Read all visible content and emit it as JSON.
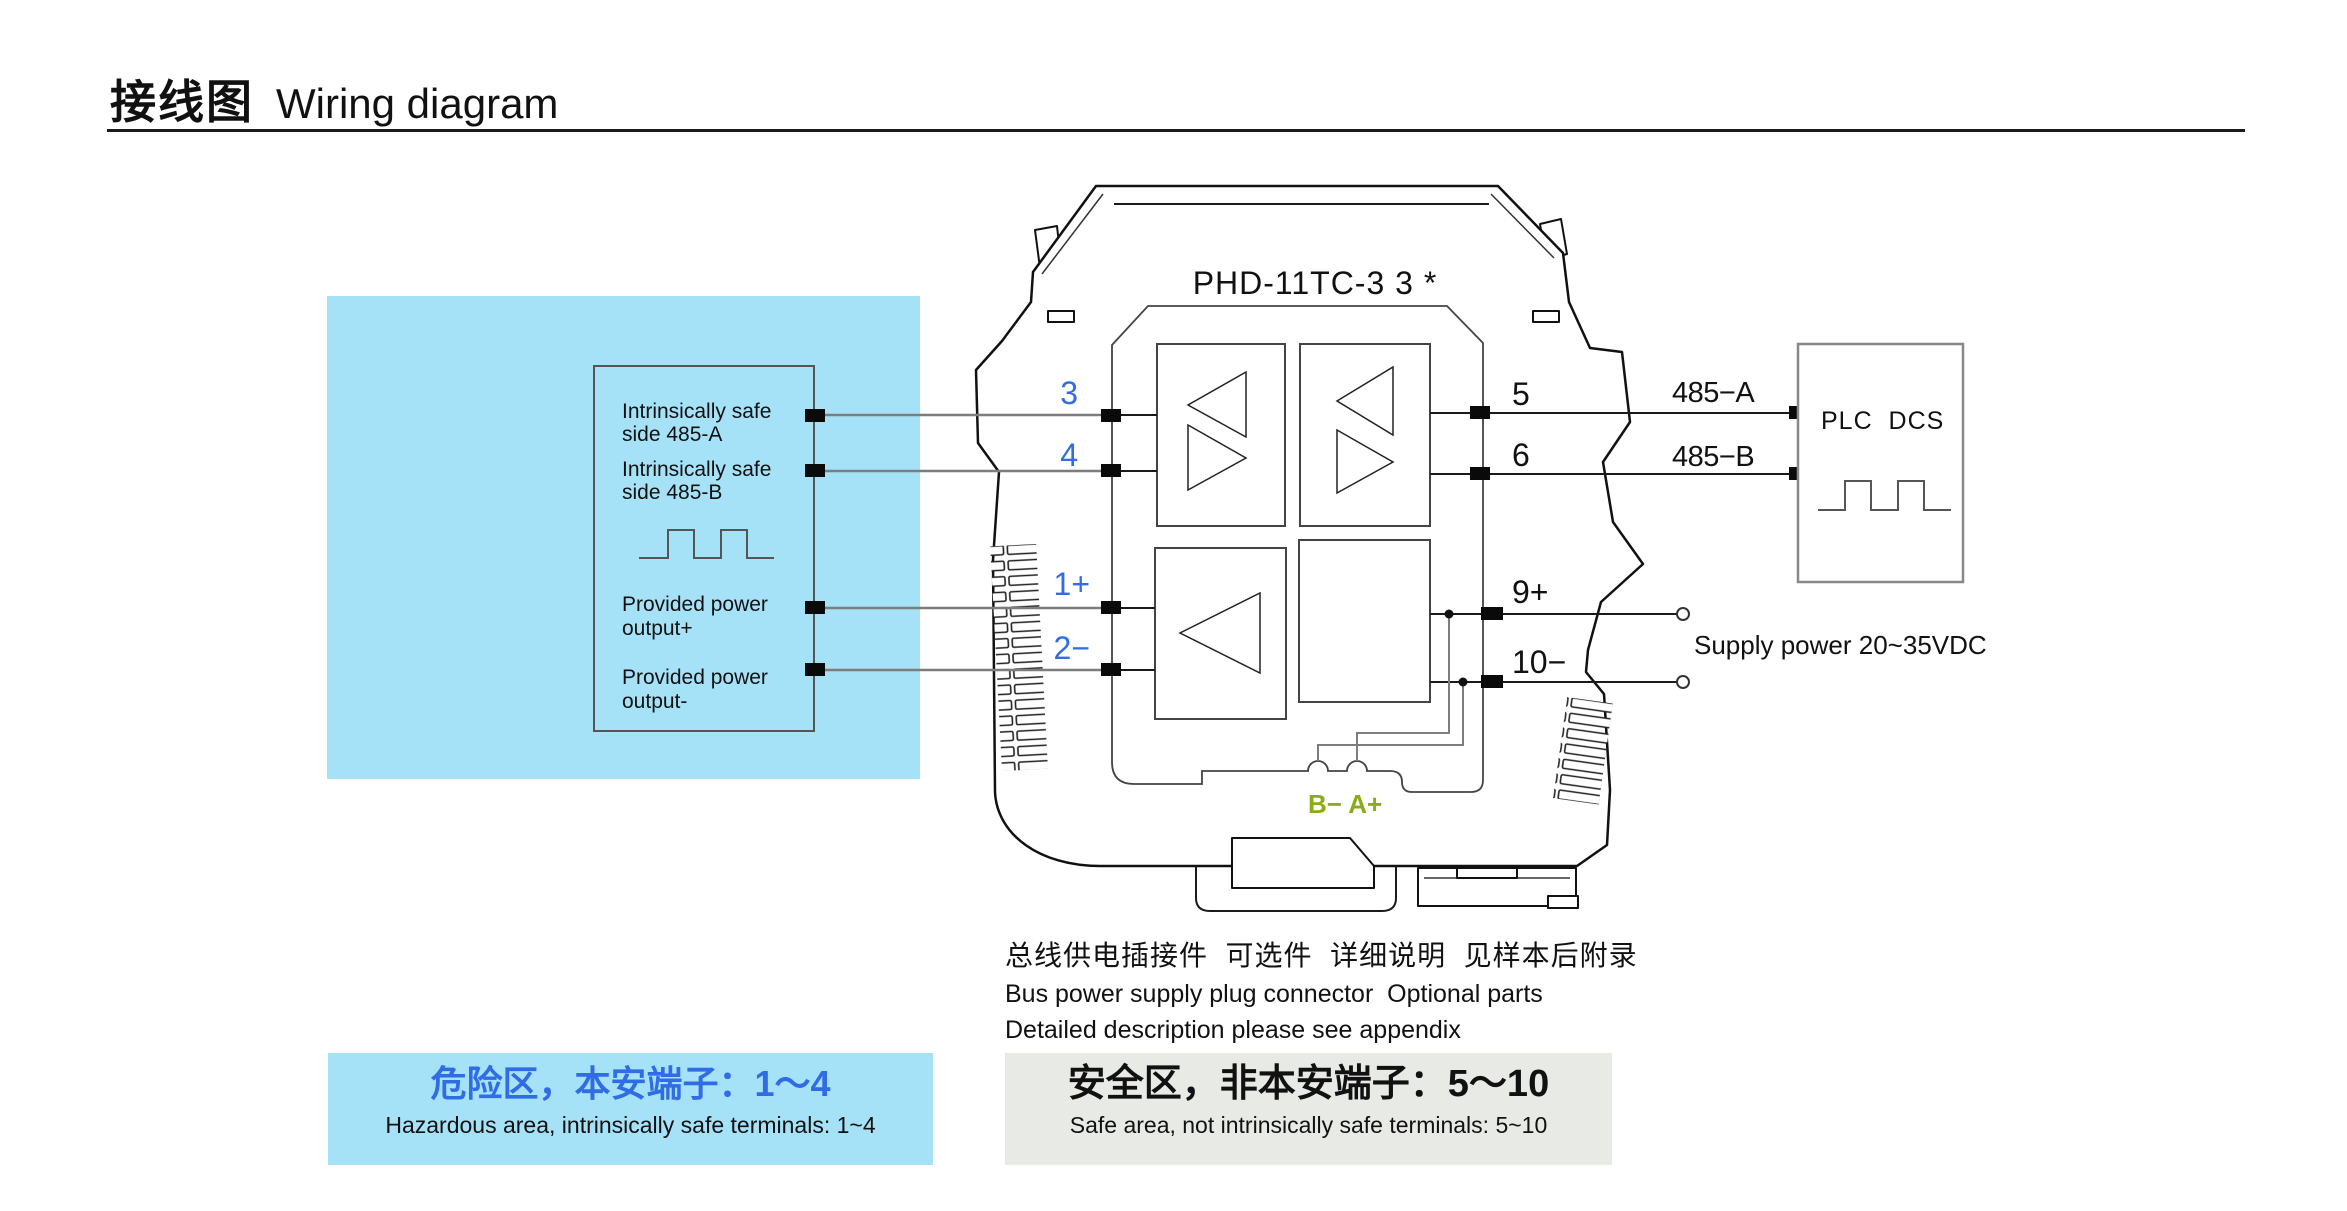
{
  "title": {
    "zh": "接线图",
    "en": "Wiring diagram"
  },
  "device": {
    "model": "PHD-11TC-3 3 *",
    "bus_label": "B− A+"
  },
  "hazard_box": {
    "lines": [
      "Intrinsically safe",
      "side 485-A",
      "Intrinsically safe",
      "side 485-B",
      "Provided power",
      "output+",
      "Provided power",
      "output-"
    ]
  },
  "terminals": {
    "left": [
      "3",
      "4",
      "1+",
      "2−"
    ],
    "right": [
      "5",
      "6",
      "9+",
      "10−"
    ]
  },
  "wires": {
    "a": "485−A",
    "b": "485−B"
  },
  "plc": {
    "label": "PLC  DCS"
  },
  "supply": {
    "label": "Supply power 20~35VDC"
  },
  "notes": {
    "zh": "总线供电插接件  可选件  详细说明  见样本后附录",
    "en1": "Bus power supply plug connector  Optional parts",
    "en2": "Detailed description please see appendix"
  },
  "zones": {
    "hazardous": {
      "zh": "危险区，本安端子：1～4",
      "en": "Hazardous area, intrinsically safe terminals: 1~4"
    },
    "safe": {
      "zh": "安全区，非本安端子：5～10",
      "en": "Safe area, not intrinsically safe terminals: 5~10"
    }
  },
  "colors": {
    "accent_blue": "#2f6ce6",
    "signal_green": "#8aac14",
    "hazard_bg": "#a5e2f8",
    "safe_bg": "#e8eae6"
  }
}
